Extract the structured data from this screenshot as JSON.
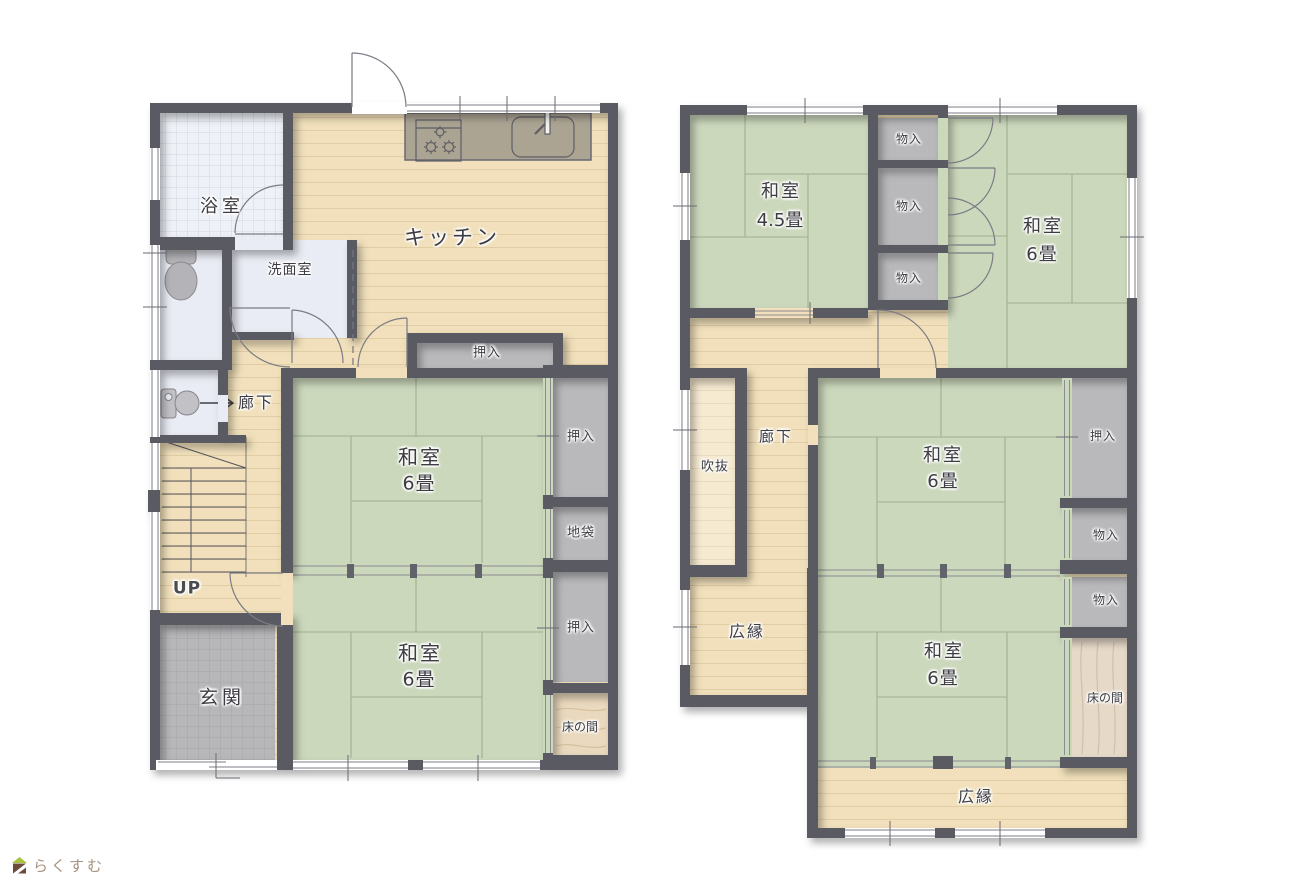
{
  "branding": {
    "logo_text": "らくすむ"
  },
  "floor1": {
    "bath": "浴室",
    "washroom": "洗面室",
    "kitchen": "キッチン",
    "hallway": "廊下",
    "stairs": "UP",
    "entrance": "玄関",
    "closet_upper": "押入",
    "closet_east_1": "押入",
    "floor_chest": "地袋",
    "closet_east_2": "押入",
    "alcove": "床の間",
    "tatami_room_1": {
      "label": "和室",
      "size": "6畳"
    },
    "tatami_room_2": {
      "label": "和室",
      "size": "6畳"
    }
  },
  "floor2": {
    "tatami_room_1": {
      "label": "和室",
      "size": "4.5畳"
    },
    "tatami_room_2": {
      "label": "和室",
      "size": "6畳"
    },
    "tatami_room_3": {
      "label": "和室",
      "size": "6畳"
    },
    "tatami_room_4": {
      "label": "和室",
      "size": "6畳"
    },
    "storage_1": "物入",
    "storage_2": "物入",
    "storage_3": "物入",
    "storage_4": "物入",
    "storage_5": "物入",
    "void": "吹抜",
    "hallway": "廊下",
    "closet": "押入",
    "alcove": "床の間",
    "veranda_west": "広縁",
    "veranda_south": "広縁"
  },
  "colors": {
    "wall": "#5a5a62",
    "wood_floor": "#f1e0bb",
    "tatami": "#ccd8bc",
    "closet": "#b9b9bc",
    "alcove_wood": "#ead9be",
    "bath_tile": "#eef1f7",
    "entrance_tile": "#b7b7ba",
    "counter": "#a7a090",
    "logo_roof": "#aac23c",
    "logo_house": "#6b4b39"
  }
}
